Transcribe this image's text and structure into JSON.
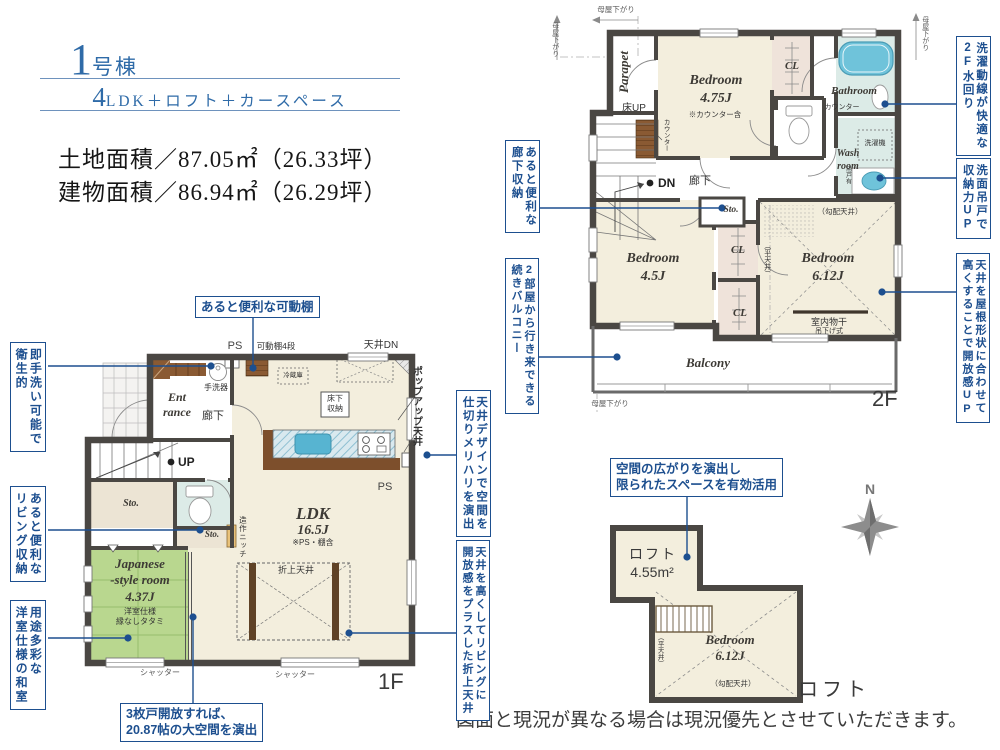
{
  "header": {
    "building_no_big": "1",
    "building_no_rest": "号棟",
    "plan_big": "4",
    "plan_rest": "LDK＋ロフト＋カースペース",
    "land_area": "土地面積／87.05㎡（26.33坪）",
    "building_area": "建物面積／86.94㎡（26.29坪）"
  },
  "callouts": {
    "handwash_hygiene": "即手洗い可能で\n衛生的",
    "living_storage": "あると便利な\nリビング収納",
    "tatami_room": "用途多彩な\n洋室仕様の和室",
    "movable_shelf": "あると便利な可動棚",
    "ceiling_design": "天井デザインで空間を\n仕切りメリハリを演出",
    "coffered_ceiling": "天井を高くしてリビングに\n開放感をプラスした折上天井",
    "corridor_storage": "あると便利な\n廊下収納",
    "balcony_access": "2部屋から行き来できる\n続きバルコニー",
    "laundry_line": "洗濯動線が快適な\n2F水回り",
    "vanity_storage": "洗面吊戸で\n収納力UP",
    "high_ceiling": "天井を屋根形状に合わせて\n高くすることで開放感UP",
    "loft_space": "空間の広がりを演出し\n限られたスペースを有効活用",
    "triple_door": "3枚戸開放すれば、\n20.87帖の大空間を演出"
  },
  "f1": {
    "ps_top": "PS",
    "movable_shelf": "可動棚4段",
    "ceiling_dn": "天井DN",
    "handwash": "手洗器",
    "entrance": "Ent\nrance",
    "corridor": "廊下",
    "up": "UP",
    "sto": "Sto.",
    "fridge": "冷蔵庫",
    "underfloor": "床下\n収納",
    "ldk": "LDK",
    "ldk_size": "16.5J",
    "ldk_note": "※PS・棚含",
    "niche": "造作ニッチ",
    "popup_ceiling": "ポップアップ天井",
    "ps_right": "PS",
    "jp_room": "Japanese\n-style room\n4.37J",
    "jp_note": "洋室仕様\n縁なしタタミ",
    "coffered": "折上天井",
    "shutter": "シャッター",
    "floor": "1F"
  },
  "f2": {
    "moya": "母屋下がり",
    "parapet": "Parapet",
    "floor_up": "床UP",
    "counter_v": "カウンター",
    "bed1": "Bedroom\n4.75J",
    "bed1_note": "※カウンター含",
    "cl": "CL",
    "bathroom": "Bathroom",
    "counter2": "カウンター",
    "washer": "洗濯機",
    "washroom": "Wash\nroom",
    "hanging_door": "吊戸有",
    "dn": "DN",
    "corridor": "廊下",
    "sto": "Sto.",
    "bed2": "Bedroom\n4.5J",
    "bed3": "Bedroom\n6.12J",
    "sloped": "（勾配天井）",
    "flat": "（平天井）",
    "drying": "室内物干",
    "hanging_type": "吊下げ式",
    "balcony": "Balcony",
    "floor": "2F"
  },
  "loft": {
    "name": "ロフト",
    "size": "4.55m²",
    "bed": "Bedroom\n6.12J",
    "sloped": "（勾配天井）",
    "flat": "（平天井）",
    "caption": "ロフト"
  },
  "compass": {
    "north": "N"
  },
  "disclaimer": "図面と現況が異なる場合は現況優先とさせていただきます。",
  "colors": {
    "accent": "#1d4f8f",
    "heading_blue": "#2f6ba8",
    "wall": "#4a4743",
    "tatami_green": "#b9d78f",
    "water_blue": "#6fc3da",
    "room_cream": "#f3eedd",
    "wet_room": "#dcebe7",
    "wood_brown": "#8a5a33"
  }
}
